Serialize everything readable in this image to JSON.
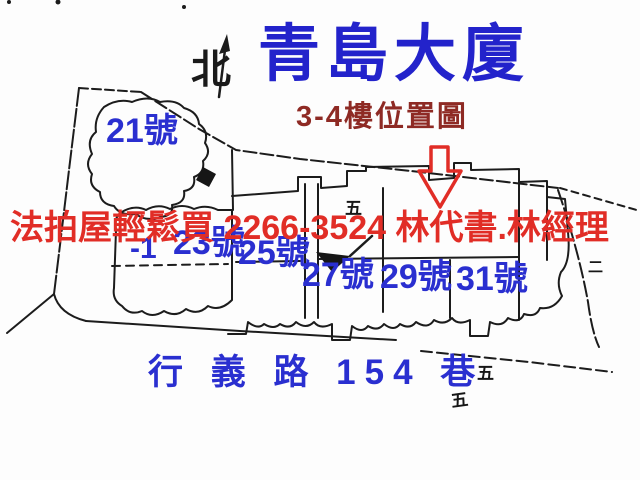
{
  "colors": {
    "title_blue": "#2323cb",
    "label_blue": "#2a2fd0",
    "subtitle_maroon": "#8e2a24",
    "ad_red": "#e12d26",
    "line_black": "#1c1c1c"
  },
  "header": {
    "title": "青島大廈",
    "subtitle": "3-4樓位置圖",
    "north_label": "北"
  },
  "overlay": {
    "ad_text": "法拍屋輕鬆買 2266-3524 林代書.林經理"
  },
  "map": {
    "units": [
      {
        "label": "21號"
      },
      {
        "label": "-1"
      },
      {
        "label": "23號"
      },
      {
        "label": "25號"
      },
      {
        "label": "27號"
      },
      {
        "label": "29號"
      },
      {
        "label": "31號"
      }
    ],
    "street_label": "行 義 路 154 巷",
    "marks": [
      {
        "text": "五"
      },
      {
        "text": "五"
      },
      {
        "text": "五"
      },
      {
        "text": "二"
      }
    ]
  }
}
